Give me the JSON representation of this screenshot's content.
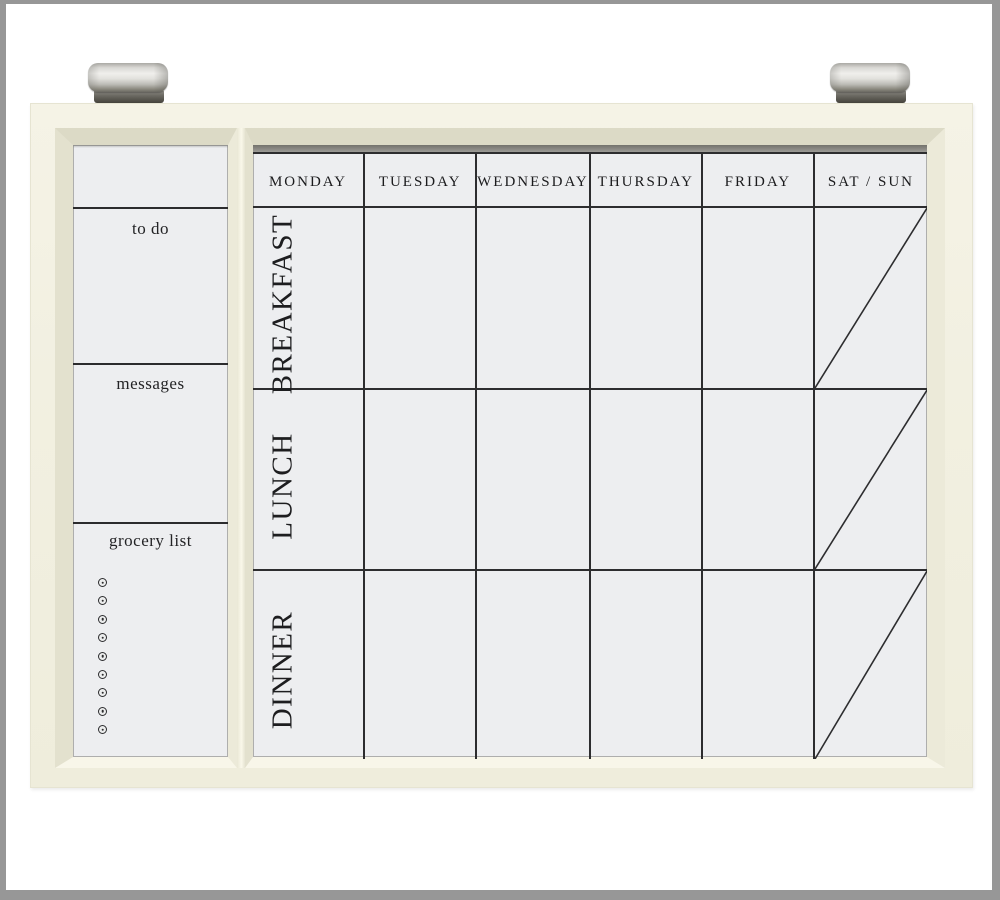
{
  "image": {
    "description": "Framed magnetic whiteboard weekly meal planner hung by two brushed-metal wall clips"
  },
  "frame": {
    "color": "#f2f0e1",
    "clip_count": 2,
    "clip_icons": [
      "metal-clip-icon",
      "metal-clip-icon"
    ]
  },
  "sidebar": {
    "sections": [
      {
        "label": "to do"
      },
      {
        "label": "messages"
      },
      {
        "label": "grocery list"
      }
    ],
    "grocery_dot_icon": "magnet-dot-icon",
    "grocery_dot_count": 9
  },
  "calendar": {
    "day_headers": [
      "MONDAY",
      "TUESDAY",
      "WEDNESDAY",
      "THURSDAY",
      "FRIDAY",
      "SAT / SUN"
    ],
    "meal_rows": [
      "BREAKFAST",
      "LUNCH",
      "DINNER"
    ],
    "weekend_diagonal": true
  },
  "colors": {
    "surface": "#edeef0",
    "grid_line": "#2d2d2f",
    "frame": "#f2f0e1",
    "metal": "#c6c5c0",
    "photo_border": "#979797"
  }
}
